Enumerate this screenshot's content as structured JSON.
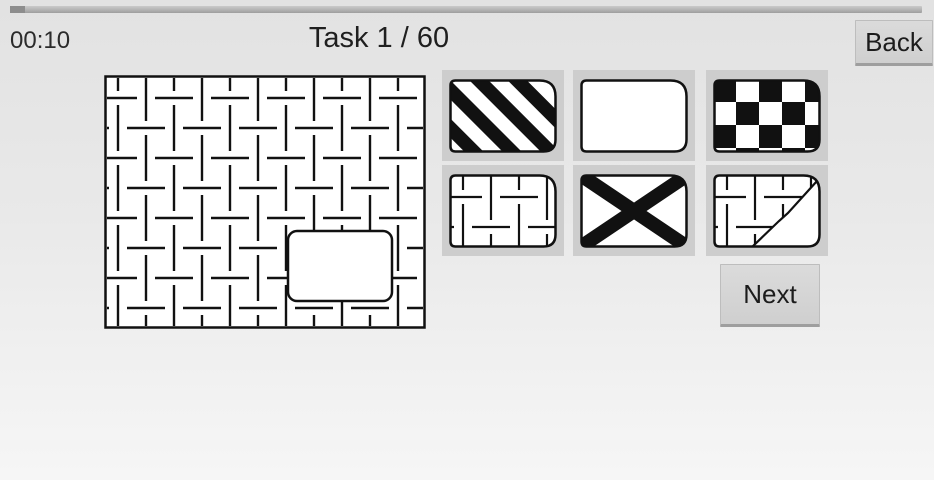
{
  "header": {
    "timer": "00:10",
    "title": "Task 1 / 60",
    "back_label": "Back"
  },
  "actions": {
    "next_label": "Next"
  },
  "puzzle": {
    "name": "dash-weave-pattern-board",
    "missing_piece": "rounded-rectangle-cutout-lower-right"
  },
  "options": [
    {
      "position": 1,
      "pattern": "diagonal-stripes"
    },
    {
      "position": 2,
      "pattern": "blank-white"
    },
    {
      "position": 3,
      "pattern": "checkerboard"
    },
    {
      "position": 4,
      "pattern": "dash-weave-match"
    },
    {
      "position": 5,
      "pattern": "x-cross"
    },
    {
      "position": 6,
      "pattern": "dash-weave-torn-diagonal"
    }
  ],
  "colors": {
    "ink": "#111111",
    "tile_bg": "#cdcdcd",
    "button_bg": "#d6d6d6",
    "page_top": "#e2e2e2",
    "page_bottom": "#f6f6f6",
    "progress_bar": "#a9a9a9"
  }
}
